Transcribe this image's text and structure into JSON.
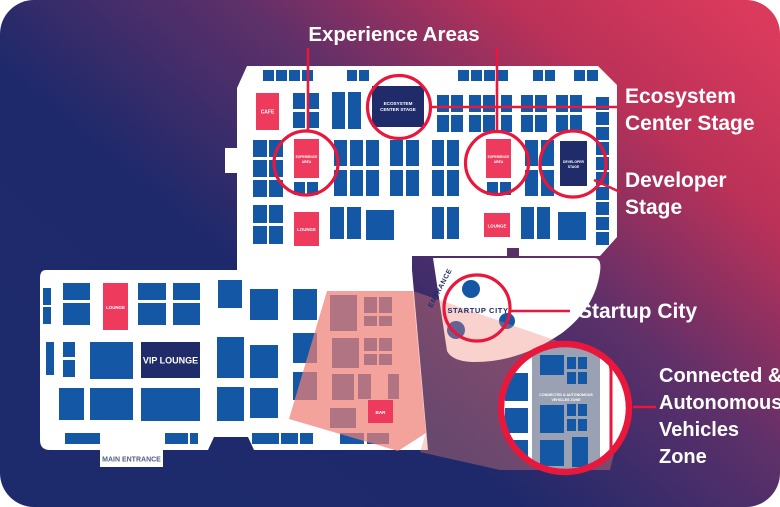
{
  "background": {
    "corner_radius": 34,
    "gradient": {
      "stops": [
        {
          "color": "#1D2A6B",
          "offset": "0%"
        },
        {
          "color": "#1E296B",
          "offset": "35%"
        },
        {
          "color": "#5E3069",
          "offset": "60%"
        },
        {
          "color": "#BB3158",
          "offset": "82%"
        },
        {
          "color": "#DA3A5C",
          "offset": "100%"
        }
      ]
    }
  },
  "colors": {
    "floor": "#FFFFFF",
    "booth_blue": "#1457A5",
    "stage_navy": "#1F2C69",
    "accent_red": "#EE3A5C",
    "highlight_stroke": "#E8173C",
    "overlay_salmon": "#EE8074",
    "magnifier_gray": "#99A1B3",
    "entrance_text_gray": "#4E5E80",
    "map_text_navy": "#1F2C69"
  },
  "title": {
    "text": "Experience Areas"
  },
  "side_labels": {
    "ecosystem": [
      "Ecosystem",
      "Center Stage"
    ],
    "developer": [
      "Developer",
      "Stage"
    ],
    "startup": "Startup City",
    "cav": [
      "Connected &",
      "Autonomous",
      "Vehicles",
      "Zone"
    ]
  },
  "map": {
    "areas": {
      "cafe": {
        "label": "CAFE"
      },
      "experience_area_1": {
        "label_lines": [
          "EXPERIENCE",
          "AREA"
        ]
      },
      "experience_area_2": {
        "label_lines": [
          "EXPERIENCE",
          "AREA"
        ]
      },
      "ecosystem_stage": {
        "label_lines": [
          "ECOSYSTEM",
          "CENTER STAGE"
        ]
      },
      "developer_stage": {
        "label_lines": [
          "DEVELOPER",
          "STAGE"
        ]
      },
      "lounge_upper_left": {
        "label": "LOUNGE"
      },
      "lounge_upper_right": {
        "label": "LOUNGE"
      },
      "lounge_lower": {
        "label": "LOUNGE"
      },
      "vip_lounge": {
        "label": "VIP LOUNGE"
      },
      "bar": {
        "label": "BAR"
      },
      "startup_city": {
        "label": "STARTUP CITY"
      },
      "entrance": {
        "label": "ENTRANCE"
      },
      "main_entrance": {
        "label": "MAIN ENTRANCE"
      },
      "cav_zone": {
        "label_lines": [
          "CONNECTED & AUTONOMOUS",
          "VEHICLES ZONE"
        ]
      }
    },
    "startup_dots": [
      [
        471,
        289,
        9
      ],
      [
        456,
        330,
        9
      ],
      [
        507,
        321,
        8
      ]
    ],
    "booths": {
      "blue_upper": [
        [
          263,
          70,
          11,
          11
        ],
        [
          276,
          70,
          11,
          11
        ],
        [
          289,
          70,
          11,
          11
        ],
        [
          302,
          70,
          11,
          11
        ],
        [
          347,
          70,
          10,
          11
        ],
        [
          359,
          70,
          10,
          11
        ],
        [
          458,
          70,
          11,
          11
        ],
        [
          471,
          70,
          11,
          11
        ],
        [
          484,
          70,
          11,
          11
        ],
        [
          497,
          70,
          11,
          11
        ],
        [
          533,
          70,
          10,
          11
        ],
        [
          545,
          70,
          10,
          11
        ],
        [
          574,
          70,
          11,
          11
        ],
        [
          587,
          70,
          11,
          11
        ],
        [
          293,
          93,
          12,
          16
        ],
        [
          307,
          93,
          12,
          16
        ],
        [
          293,
          112,
          12,
          16
        ],
        [
          307,
          112,
          12,
          16
        ],
        [
          332,
          92,
          13,
          37
        ],
        [
          348,
          92,
          13,
          37
        ],
        [
          437,
          95,
          12,
          17
        ],
        [
          451,
          95,
          12,
          17
        ],
        [
          437,
          115,
          12,
          17
        ],
        [
          451,
          115,
          12,
          17
        ],
        [
          469,
          95,
          12,
          17
        ],
        [
          483,
          95,
          12,
          17
        ],
        [
          469,
          115,
          12,
          17
        ],
        [
          483,
          115,
          12,
          17
        ],
        [
          501,
          95,
          11,
          17
        ],
        [
          501,
          115,
          11,
          17
        ],
        [
          521,
          95,
          12,
          17
        ],
        [
          535,
          95,
          12,
          17
        ],
        [
          521,
          115,
          12,
          17
        ],
        [
          535,
          115,
          12,
          17
        ],
        [
          556,
          95,
          12,
          17
        ],
        [
          570,
          95,
          12,
          17
        ],
        [
          556,
          115,
          12,
          17
        ],
        [
          570,
          115,
          12,
          17
        ],
        [
          253,
          140,
          14,
          17
        ],
        [
          269,
          140,
          14,
          17
        ],
        [
          253,
          160,
          14,
          17
        ],
        [
          269,
          160,
          14,
          17
        ],
        [
          253,
          180,
          14,
          17
        ],
        [
          269,
          180,
          14,
          17
        ],
        [
          334,
          140,
          13,
          26
        ],
        [
          350,
          140,
          13,
          26
        ],
        [
          366,
          140,
          13,
          26
        ],
        [
          334,
          170,
          13,
          26
        ],
        [
          350,
          170,
          13,
          26
        ],
        [
          366,
          170,
          13,
          26
        ],
        [
          390,
          140,
          13,
          26
        ],
        [
          406,
          140,
          13,
          26
        ],
        [
          390,
          170,
          13,
          26
        ],
        [
          406,
          170,
          13,
          26
        ],
        [
          432,
          140,
          12,
          26
        ],
        [
          447,
          140,
          12,
          26
        ],
        [
          432,
          170,
          12,
          26
        ],
        [
          447,
          170,
          12,
          26
        ],
        [
          525,
          140,
          13,
          26
        ],
        [
          541,
          140,
          13,
          26
        ],
        [
          525,
          170,
          13,
          26
        ],
        [
          541,
          170,
          13,
          26
        ],
        [
          294,
          182,
          11,
          13
        ],
        [
          307,
          182,
          11,
          13
        ],
        [
          487,
          182,
          11,
          13
        ],
        [
          500,
          182,
          11,
          13
        ],
        [
          253,
          205,
          14,
          18
        ],
        [
          269,
          205,
          14,
          18
        ],
        [
          253,
          226,
          14,
          18
        ],
        [
          269,
          226,
          14,
          18
        ],
        [
          330,
          207,
          14,
          32
        ],
        [
          347,
          207,
          14,
          32
        ],
        [
          366,
          210,
          28,
          30
        ],
        [
          432,
          207,
          12,
          32
        ],
        [
          447,
          207,
          12,
          32
        ],
        [
          521,
          207,
          13,
          32
        ],
        [
          537,
          207,
          13,
          32
        ],
        [
          558,
          212,
          28,
          28
        ],
        [
          596,
          97,
          13,
          13
        ],
        [
          596,
          112,
          13,
          13
        ],
        [
          596,
          127,
          13,
          13
        ],
        [
          596,
          142,
          13,
          13
        ],
        [
          596,
          157,
          13,
          13
        ],
        [
          596,
          172,
          13,
          13
        ],
        [
          596,
          187,
          13,
          13
        ],
        [
          596,
          202,
          13,
          13
        ],
        [
          596,
          217,
          13,
          13
        ],
        [
          596,
          232,
          13,
          13
        ]
      ],
      "blue_lower": [
        [
          43,
          288,
          8,
          17
        ],
        [
          43,
          307,
          8,
          17
        ],
        [
          63,
          283,
          27,
          17
        ],
        [
          63,
          303,
          27,
          22
        ],
        [
          138,
          283,
          28,
          17
        ],
        [
          138,
          303,
          28,
          22
        ],
        [
          173,
          283,
          27,
          17
        ],
        [
          173,
          303,
          27,
          22
        ],
        [
          218,
          280,
          24,
          28
        ],
        [
          250,
          289,
          28,
          31
        ],
        [
          46,
          342,
          8,
          33
        ],
        [
          63,
          342,
          12,
          15
        ],
        [
          63,
          360,
          12,
          17
        ],
        [
          90,
          342,
          43,
          37
        ],
        [
          217,
          337,
          27,
          41
        ],
        [
          250,
          345,
          28,
          33
        ],
        [
          59,
          388,
          25,
          32
        ],
        [
          90,
          388,
          43,
          32
        ],
        [
          141,
          388,
          59,
          33
        ],
        [
          217,
          387,
          27,
          34
        ],
        [
          250,
          388,
          28,
          30
        ],
        [
          65,
          433,
          35,
          11
        ],
        [
          165,
          433,
          23,
          11
        ],
        [
          190,
          433,
          8,
          11
        ],
        [
          252,
          433,
          27,
          11
        ],
        [
          281,
          433,
          17,
          11
        ],
        [
          300,
          433,
          13,
          11
        ],
        [
          293,
          289,
          24,
          31
        ],
        [
          293,
          333,
          24,
          30
        ],
        [
          293,
          372,
          24,
          28
        ]
      ],
      "blue_zone": [
        [
          330,
          295,
          27,
          36
        ],
        [
          364,
          297,
          13,
          16
        ],
        [
          379,
          297,
          13,
          16
        ],
        [
          364,
          316,
          13,
          10
        ],
        [
          379,
          316,
          13,
          10
        ],
        [
          332,
          338,
          27,
          30
        ],
        [
          364,
          338,
          13,
          13
        ],
        [
          379,
          338,
          13,
          13
        ],
        [
          364,
          354,
          13,
          11
        ],
        [
          379,
          354,
          13,
          11
        ],
        [
          332,
          374,
          22,
          26
        ],
        [
          358,
          374,
          13,
          25
        ],
        [
          388,
          374,
          11,
          25
        ],
        [
          330,
          408,
          26,
          20
        ],
        [
          340,
          433,
          24,
          11
        ],
        [
          367,
          433,
          22,
          11
        ]
      ],
      "magnifier": [
        [
          505,
          352,
          14,
          14
        ],
        [
          540,
          355,
          24,
          20
        ],
        [
          505,
          373,
          23,
          28
        ],
        [
          505,
          408,
          23,
          25
        ],
        [
          510,
          440,
          18,
          20
        ],
        [
          540,
          405,
          24,
          28
        ],
        [
          540,
          440,
          24,
          26
        ],
        [
          572,
          437,
          16,
          30
        ],
        [
          548,
          470,
          22,
          12
        ],
        [
          567,
          357,
          9,
          12
        ],
        [
          578,
          357,
          9,
          12
        ],
        [
          567,
          372,
          9,
          12
        ],
        [
          578,
          372,
          9,
          12
        ],
        [
          567,
          404,
          9,
          12
        ],
        [
          578,
          404,
          9,
          12
        ],
        [
          567,
          419,
          9,
          12
        ],
        [
          578,
          419,
          9,
          12
        ]
      ]
    }
  }
}
